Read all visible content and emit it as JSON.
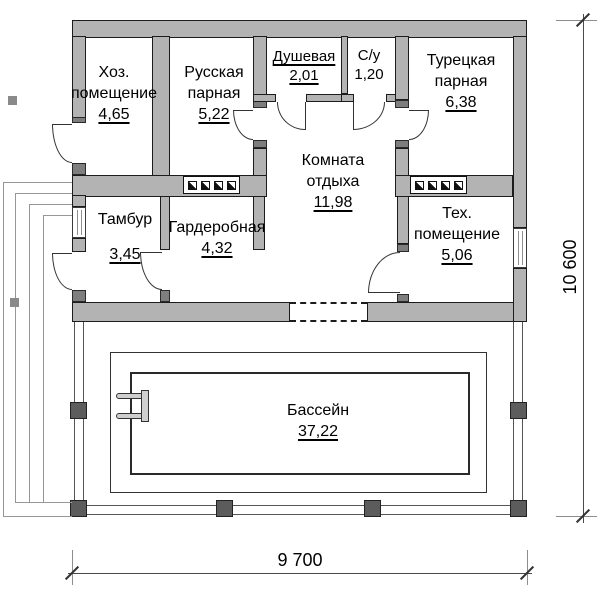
{
  "drawing": {
    "type": "floor-plan",
    "overall_width": "9 700",
    "overall_height": "10 600"
  },
  "rooms": [
    {
      "id": "hoz",
      "name": "Хоз. помещение",
      "area": "4,65"
    },
    {
      "id": "russkaya",
      "name": "Русская парная",
      "area": "5,22"
    },
    {
      "id": "dushevaya",
      "name": "Душевая",
      "area": "2,01"
    },
    {
      "id": "su",
      "name": "С/у",
      "area": "1,20"
    },
    {
      "id": "turetskaya",
      "name": "Турецкая парная",
      "area": "6,38"
    },
    {
      "id": "komnata",
      "name": "Комната отдыха",
      "area": "11,98"
    },
    {
      "id": "tambur",
      "name": "Тамбур",
      "area": "3,45"
    },
    {
      "id": "garderob",
      "name": "Гардеробная",
      "area": "4,32"
    },
    {
      "id": "teh",
      "name": "Тех. помещение",
      "area": "5,06"
    },
    {
      "id": "bassein",
      "name": "Бассейн",
      "area": "37,22"
    }
  ],
  "icons": {
    "heater": "sauna-heater-icon",
    "ladder": "pool-ladder-icon"
  },
  "colors": {
    "wall_fill": "#b3b3b3",
    "wall_outline": "#1c1c1c",
    "post": "#5c5c5c",
    "dimension": "#4a4a4a"
  }
}
